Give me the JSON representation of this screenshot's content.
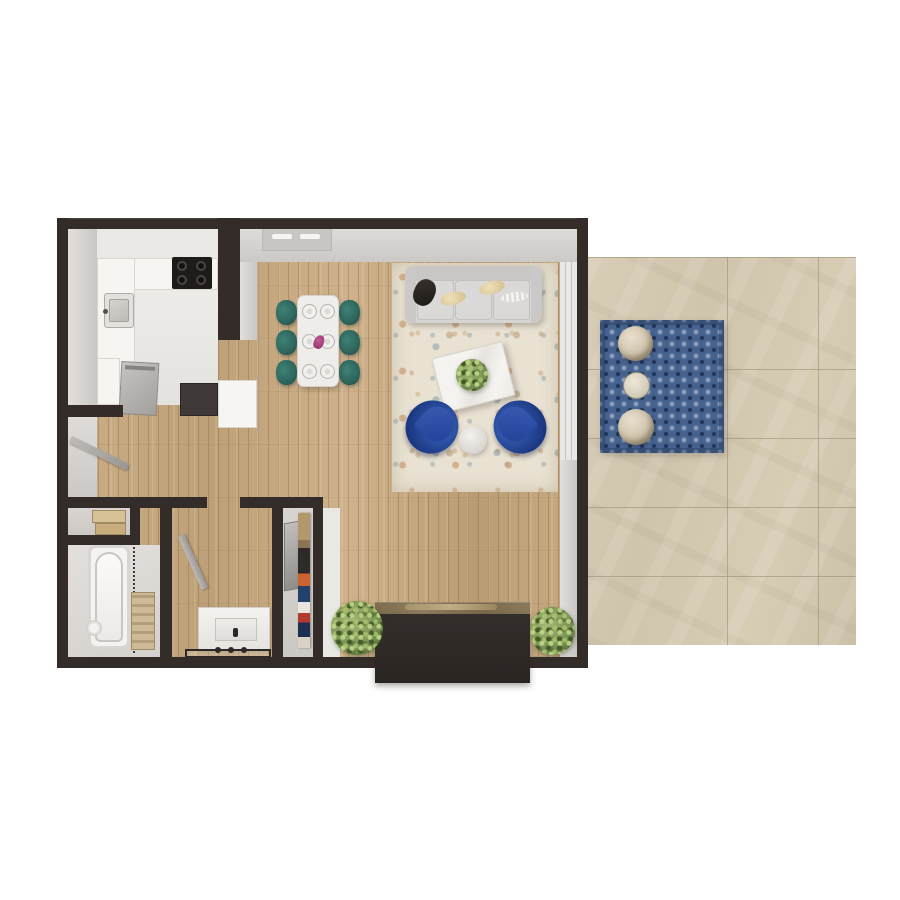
{
  "scene": {
    "type": "3d-floor-plan-top-down-render",
    "description": "Top-down 3D rendering of a one-bedroom-style apartment floor plan with open kitchen, dining area, living room with fireplace, bathroom, closets, and an attached tiled patio with outdoor rug and chairs",
    "text_visible": "none"
  },
  "colors": {
    "wall": "#332c28",
    "wood": "#c5a87f",
    "rug": "#e9e2d3",
    "tile": "#d4c9b1",
    "prug": "#46628e",
    "teal_chair": "#2c635a",
    "navy_chair": "#1d3b87",
    "plant": "#7d9256",
    "fireplace": "#2e2927",
    "counter": "#f6f5f2",
    "stainless": "#b7b4b1"
  },
  "rooms": [
    {
      "name": "kitchen",
      "furnishings": [
        "u-shaped-counter",
        "stove-cooktop",
        "kitchen-sink",
        "dishwasher",
        "refrigerator",
        "upper-cabinets"
      ]
    },
    {
      "name": "dining-area",
      "furnishings": [
        "dining-table",
        "six-teal-chairs",
        "six-place-settings",
        "magenta-centerpiece"
      ]
    },
    {
      "name": "living-room",
      "furnishings": [
        "gray-sofa",
        "throw-pillows",
        "cream-area-rug",
        "white-coffee-table",
        "green-plant",
        "two-navy-armchairs",
        "round-side-table",
        "fireplace-with-mantel",
        "two-green-shrubs"
      ]
    },
    {
      "name": "hallway",
      "furnishings": [
        "open-interior-door"
      ]
    },
    {
      "name": "linen-closet",
      "furnishings": [
        "shelf-with-towels"
      ]
    },
    {
      "name": "bathroom",
      "furnishings": [
        "bathtub",
        "shower-curtain",
        "ladder-shelf"
      ]
    },
    {
      "name": "vanity-room",
      "furnishings": [
        "vanity-sink",
        "bath-mat",
        "open-interior-door"
      ]
    },
    {
      "name": "wardrobe-closet",
      "furnishings": [
        "mirror",
        "hanging-clothes"
      ]
    },
    {
      "name": "patio",
      "furnishings": [
        "tile-floor",
        "blue-patterned-outdoor-rug",
        "two-round-outdoor-chairs",
        "round-outdoor-table"
      ]
    }
  ]
}
